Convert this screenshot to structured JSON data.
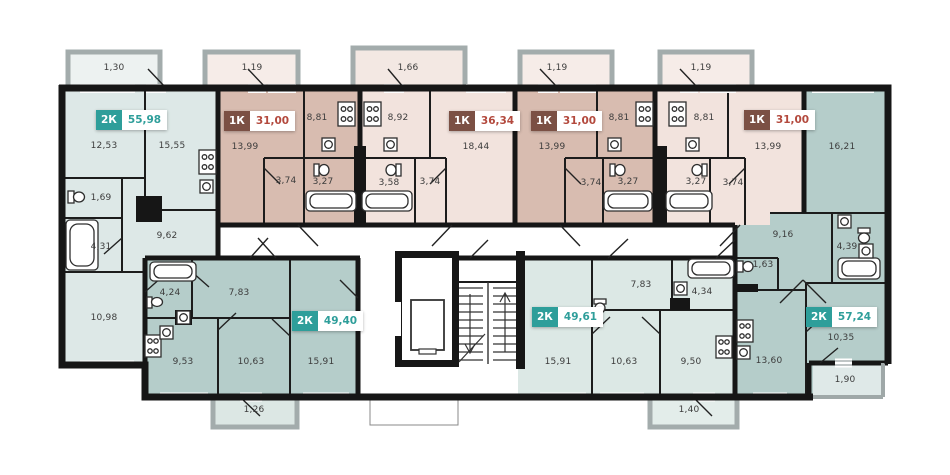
{
  "colors": {
    "badge_teal": "#2E9E9A",
    "badge_brown": "#7B5044",
    "area_text_teal": "#2E9E9A",
    "area_text_red": "#B3493D",
    "fill_teal_light": "#DDE8E7",
    "fill_teal_dark": "#B5CDCA",
    "fill_pink_light": "#F2E3DD",
    "fill_pink_dark": "#D8BCB0",
    "wall": "#161616",
    "balcony_gray": "#A3ACAC",
    "room_label": "#3C3C3C"
  },
  "apartments": [
    {
      "id": "apt-1",
      "type": "2К",
      "total_area": "55,98",
      "scheme": "teal",
      "rooms": [
        {
          "area": "12,53"
        },
        {
          "area": "15,55"
        },
        {
          "area": "1,69"
        },
        {
          "area": "4,31"
        },
        {
          "area": "9,62"
        },
        {
          "area": "10,98"
        }
      ],
      "balcony": {
        "area": "1,30"
      }
    },
    {
      "id": "apt-2",
      "type": "1К",
      "total_area": "31,00",
      "scheme": "brown",
      "rooms": [
        {
          "area": "13,99"
        },
        {
          "area": "8,81"
        },
        {
          "area": "3,74"
        },
        {
          "area": "3,27"
        }
      ],
      "balcony": {
        "area": "1,19"
      }
    },
    {
      "id": "apt-3",
      "type": "1К",
      "total_area": "36,34",
      "scheme": "brown",
      "rooms": [
        {
          "area": "8,92"
        },
        {
          "area": "18,44"
        },
        {
          "area": "3,58"
        },
        {
          "area": "3,74"
        }
      ],
      "balcony": {
        "area": "1,66"
      }
    },
    {
      "id": "apt-4",
      "type": "1К",
      "total_area": "31,00",
      "scheme": "brown",
      "rooms": [
        {
          "area": "13,99"
        },
        {
          "area": "8,81"
        },
        {
          "area": "3,74"
        },
        {
          "area": "3,27"
        }
      ],
      "balcony": {
        "area": "1,19"
      }
    },
    {
      "id": "apt-5",
      "type": "1К",
      "total_area": "31,00",
      "scheme": "brown",
      "rooms": [
        {
          "area": "8,81"
        },
        {
          "area": "3,27"
        },
        {
          "area": "3,74"
        },
        {
          "area": "13,99"
        }
      ],
      "balcony": {
        "area": "1,19"
      }
    },
    {
      "id": "apt-6",
      "type": "2К",
      "total_area": "57,24",
      "scheme": "teal",
      "rooms": [
        {
          "area": "16,21"
        },
        {
          "area": "9,16"
        },
        {
          "area": "4,39"
        },
        {
          "area": "1,63"
        },
        {
          "area": "13,60"
        },
        {
          "area": "10,35"
        },
        {
          "area": "1,90"
        }
      ]
    },
    {
      "id": "apt-7",
      "type": "2К",
      "total_area": "49,40",
      "scheme": "teal",
      "rooms": [
        {
          "area": "4,24"
        },
        {
          "area": "7,83"
        },
        {
          "area": "9,53"
        },
        {
          "area": "10,63"
        },
        {
          "area": "15,91"
        }
      ],
      "balcony": {
        "area": "1,26"
      }
    },
    {
      "id": "apt-8",
      "type": "2К",
      "total_area": "49,61",
      "scheme": "teal",
      "rooms": [
        {
          "area": "7,83"
        },
        {
          "area": "4,34"
        },
        {
          "area": "15,91"
        },
        {
          "area": "10,63"
        },
        {
          "area": "9,50"
        }
      ],
      "balcony": {
        "area": "1,40"
      }
    }
  ]
}
